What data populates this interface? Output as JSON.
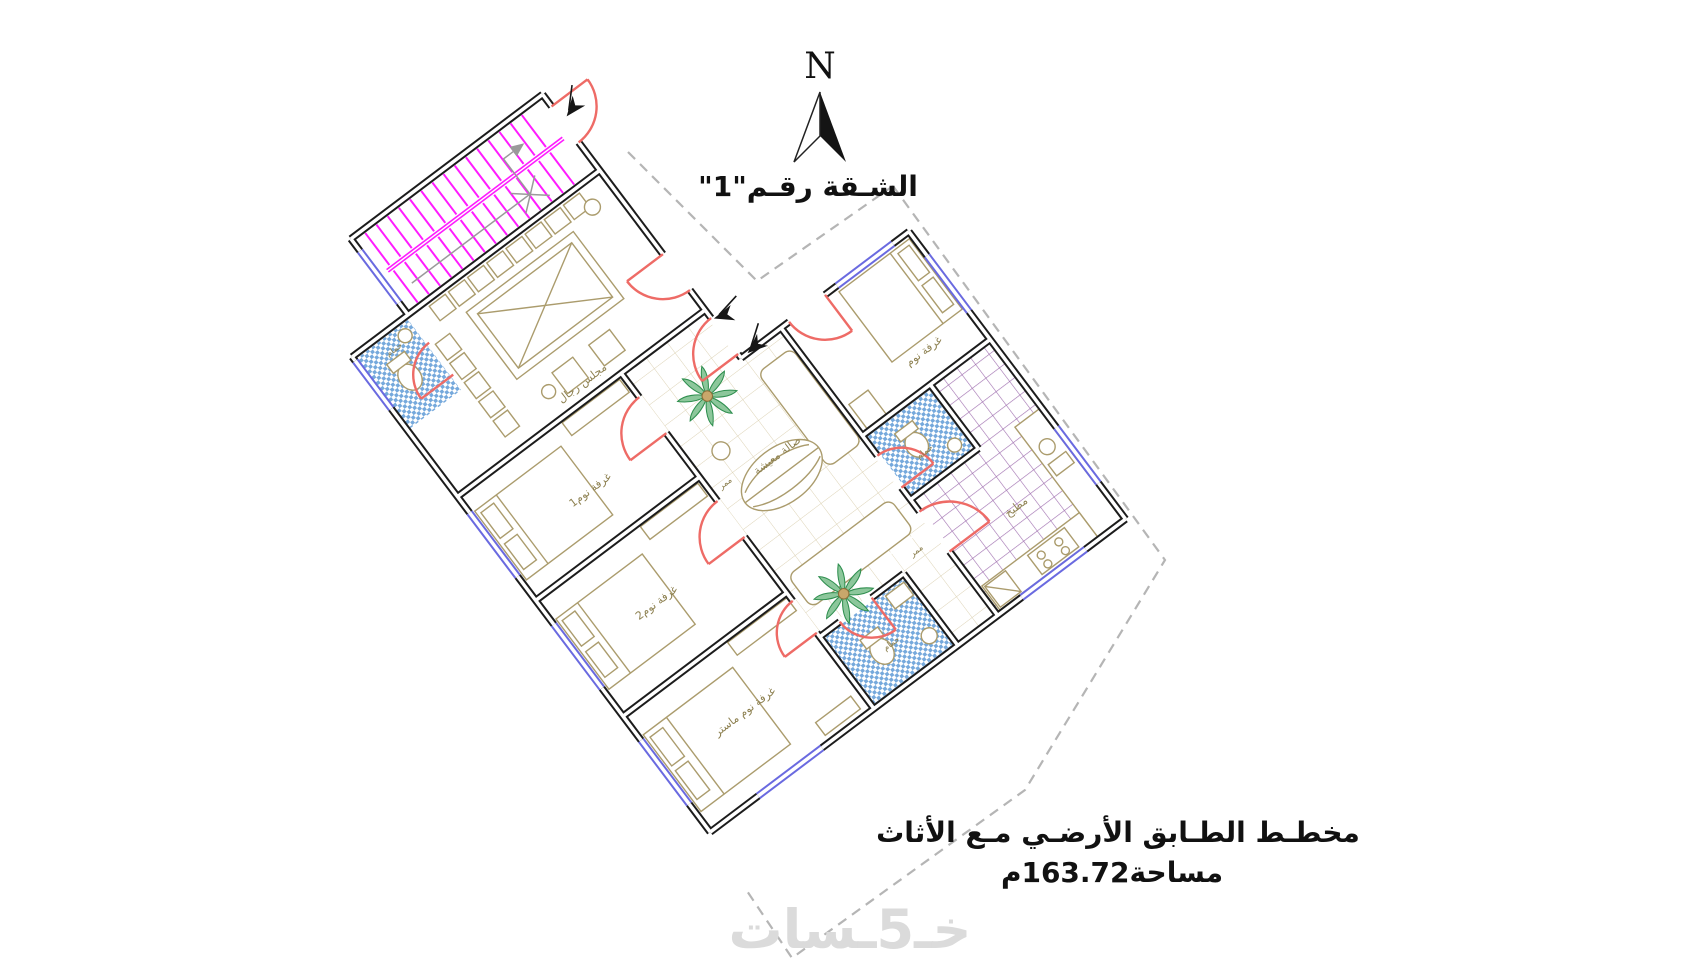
{
  "compass": {
    "n": "N"
  },
  "title": "الشـقة رقـم\"1\"",
  "caption": {
    "line1": "مخطـط الطـابق الأرضـي مـع الأثاث",
    "line2": "مساحة163.72م"
  },
  "watermark": "خـ5ـسات",
  "rooms": {
    "majlis": "مجلس رجال",
    "hall": "صالة معيشة",
    "bedroom_ne": "غرفة نوم",
    "bedroom1": "غرفة نوم1",
    "bedroom2": "غرفة نوم2",
    "master": "غرفة نوم ماستر",
    "kitchen": "مطبخ",
    "bath_wc": "حمام",
    "bath_bottom": "حمام",
    "bath_right": "حمام",
    "corridor1": "ممر",
    "corridor2": "ممر"
  },
  "colors": {
    "wall": "#1c1c1c",
    "door": "#ee6b66",
    "window": "#6a6ae0",
    "stairs": "#ff1cff",
    "mosaic_tile": "#76a9dc",
    "kitchen_grid": "#a070b0",
    "furniture": "#ab9c6d",
    "room_label": "#8d8050",
    "dashed_boundary": "#b5b5b5",
    "watermark": "#dbdbdb"
  }
}
